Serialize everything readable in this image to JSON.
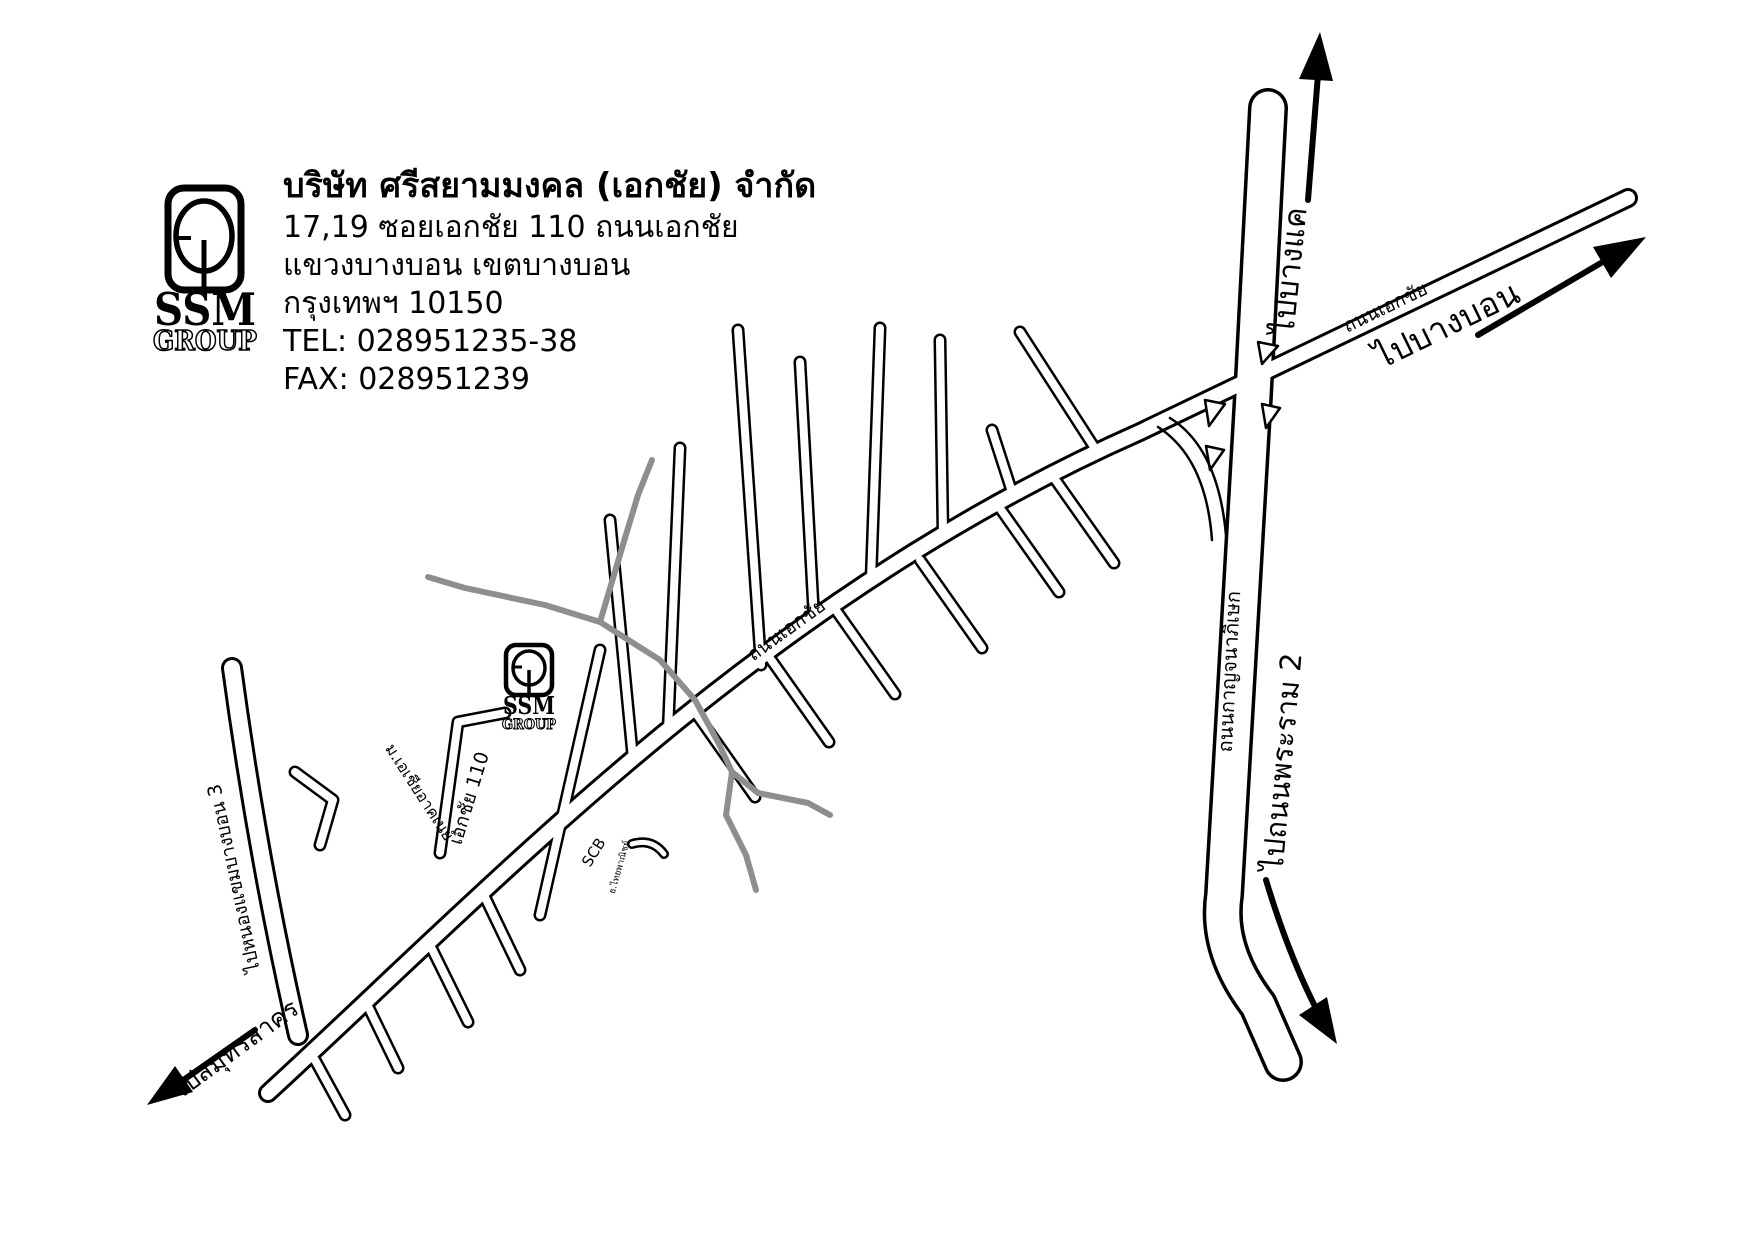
{
  "company": {
    "name": "บริษัท ศรีสยามมงคล (เอกชัย) จำกัด",
    "address_line1": "17,19 ซอยเอกชัย 110 ถนนเอกชัย",
    "address_line2": "แขวงบางบอน เขตบางบอน",
    "address_line3": "กรุงเทพฯ 10150",
    "tel": "TEL: 028951235-38",
    "fax": "FAX: 028951239",
    "logo": {
      "text": "SSM",
      "subtext": "GROUP"
    }
  },
  "map": {
    "road_labels": {
      "ekkachai_sw": "ถนนเอกชัย",
      "ekkachai_ne": "ถนนเอกชัย",
      "kanchanaphisek": "ถนนกาญจนาภิเษก",
      "soi_110": "เอกชัย 110"
    },
    "direction_labels": {
      "to_bang_khae": "ไปบางแค",
      "to_bang_bon": "ไปบางบอน",
      "to_rama2": "ไปถนนพระราม 2",
      "to_samut_sakhon": "ไปสมุทรสาคร",
      "to_nong_khaem": "ไปหนองแขมบางบอน 3"
    },
    "poi": {
      "scb": "SCB",
      "scb_bank": "ธ.ไทยพาณิชย์",
      "university": "ม.เอเชียอาคเนย์",
      "office_marker": {
        "text": "SSM",
        "subtext": "GROUP"
      }
    },
    "colors": {
      "road_stroke": "#000000",
      "road_fill": "#ffffff",
      "minor_road_gray": "#8e8e8e",
      "background": "#ffffff"
    }
  }
}
